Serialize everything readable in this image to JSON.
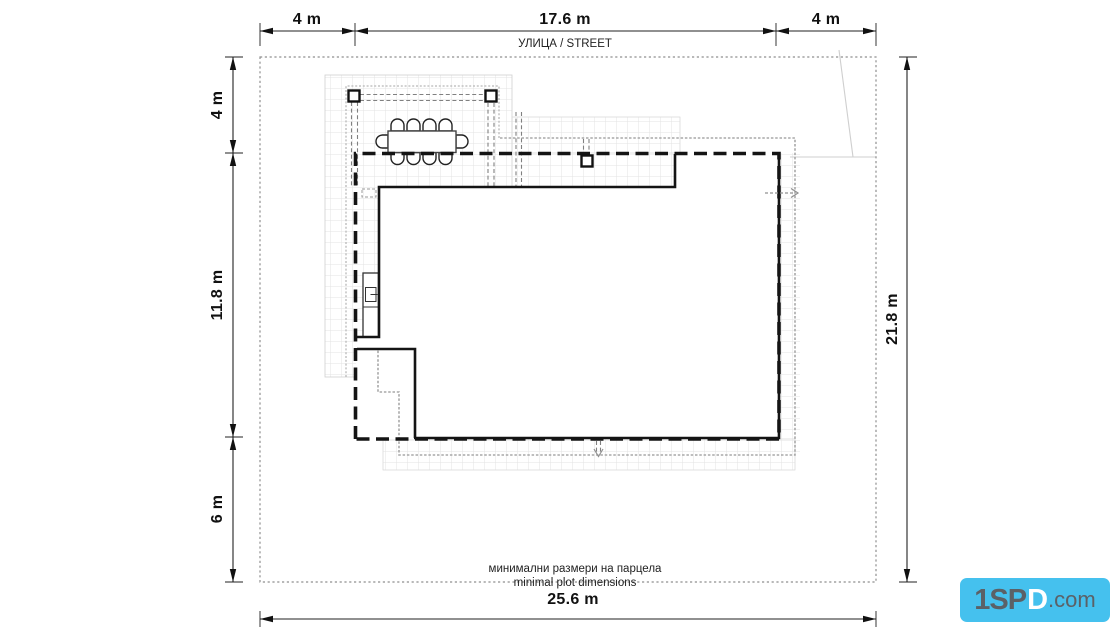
{
  "dimensions": {
    "top_left": "4 m",
    "top_center": "17.6 m",
    "top_right": "4 m",
    "left_top": "4 m",
    "left_middle": "11.8 m",
    "left_bottom": "6 m",
    "right_side": "21.8 m",
    "bottom": "25.6 m"
  },
  "labels": {
    "street": "УЛИЦА / STREET",
    "note_primary": "минимални размери на парцела",
    "note_secondary": "minimal plot dimensions"
  },
  "logo": {
    "part1": "1SP",
    "part2": "D",
    "part3": ".com"
  },
  "colors": {
    "wall": "#141414",
    "dimension_line": "#222222",
    "plot_border": "#8f8f8f",
    "grid": "#e3e3e3",
    "overhang": "#a8a8a8",
    "logo_background": "#45c1ee"
  }
}
